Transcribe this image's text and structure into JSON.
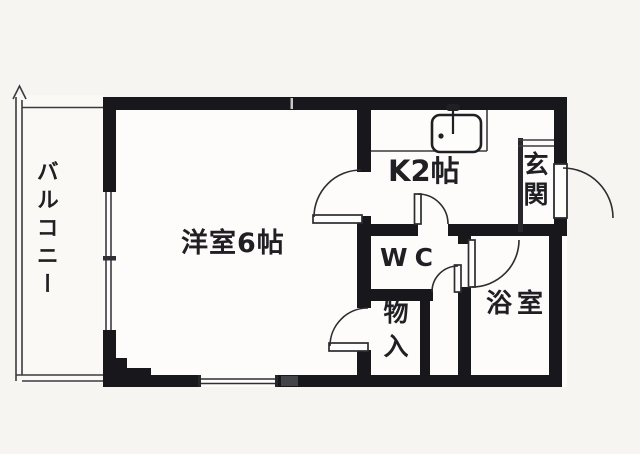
{
  "floorplan": {
    "title": "1K apartment floor plan",
    "rooms": [
      {
        "id": "balcony",
        "label": "バルコニー"
      },
      {
        "id": "western-room",
        "label": "洋室6帖"
      },
      {
        "id": "kitchen",
        "label": "K2帖"
      },
      {
        "id": "entrance",
        "label": "玄関"
      },
      {
        "id": "toilet",
        "label": "WC"
      },
      {
        "id": "storage",
        "label": "物入"
      },
      {
        "id": "bathroom",
        "label": "浴室"
      }
    ],
    "fixtures": [
      {
        "id": "kitchen-sink",
        "icon": "sink-icon"
      }
    ],
    "colors": {
      "wall": "#17171c",
      "line": "#3a3a41",
      "paper": "#f7f5f1",
      "floor": "#fdfcfa",
      "text": "#1f1f24"
    }
  }
}
